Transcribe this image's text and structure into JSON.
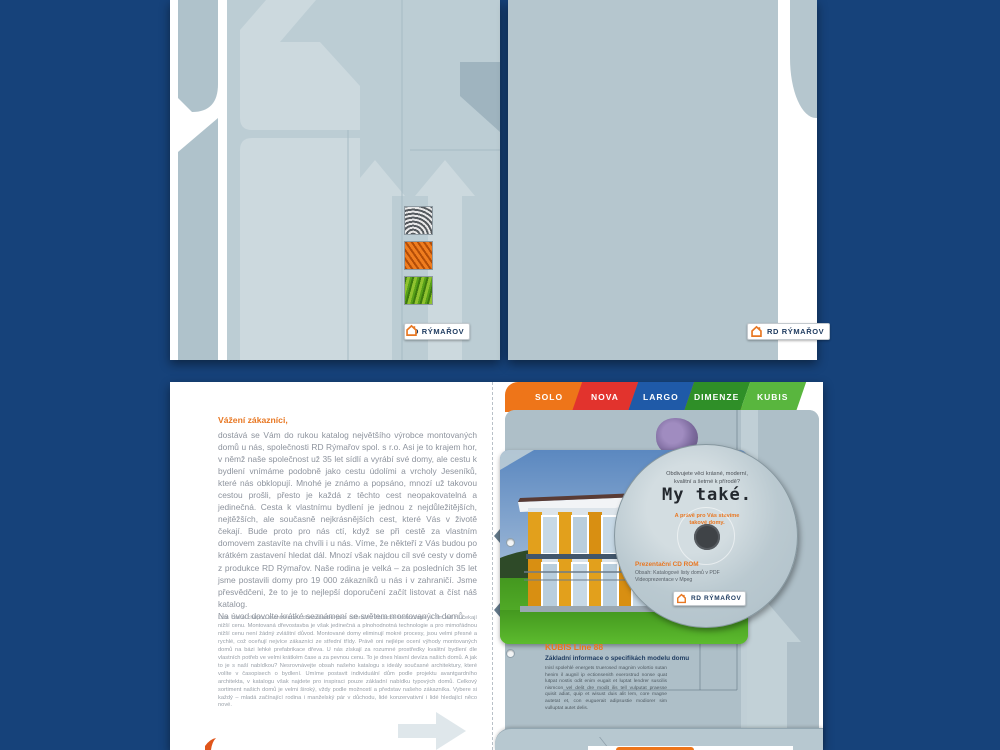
{
  "colors": {
    "background_navy": "#16427a",
    "cover_blue_gray": "#b5c6ce",
    "accent_orange": "#e87722",
    "tab_solo": "#ee7519",
    "tab_nova": "#e2332d",
    "tab_largo": "#1f5aa8",
    "tab_dimenze": "#2f8f28",
    "tab_kubis": "#59b63e"
  },
  "cover_front": {
    "logo": "RD RÝMAŘOV",
    "textures": [
      {
        "name": "fingerprint-texture"
      },
      {
        "name": "wood-texture"
      },
      {
        "name": "grass-texture"
      }
    ]
  },
  "cover_back": {
    "logo": "RD RÝMAŘOV"
  },
  "spread": {
    "left_page": {
      "heading": "Vážení zákazníci,",
      "paragraph1": "dostává se Vám do rukou katalog největšího výrobce montovaných domů u nás, společnosti RD Rýmařov spol. s r.o. Asi je to krajem hor, v němž naše společnost už 35 let sídlí a vyrábí své domy, ale cestu k bydlení vnímáme podobně jako cestu údolími a vrcholy Jeseníků, které nás obklopují. Mnohé je známo a popsáno, mnozí už takovou cestou prošli, přesto je každá z těchto cest neopakovatelná a jedinečná. Cesta k vlastnímu bydlení je jednou z nejdůležitějších, nejtěžších, ale současně nejkrásnějších cest, které Vás v životě čekají. Bude proto pro nás ctí, když se při cestě za vlastním domovem zastavíte na chvíli i u nás. Víme, že někteří z Vás budou po krátkém zastavení hledat dál. Mnozí však najdou cíl své cesty v domě z produkce RD Rýmařov. Naše rodina je velká – za posledních 35 let jsme postavili domy pro 19 000 zákazníků u nás i v zahraničí. Jsme přesvědčeni, že to je to nejlepší doporučení začít listovat a číst náš katalog.\nNa úvod dovolte krátké seznámení se světem montovaných domů.",
      "paragraph2": "Lidé často chápou montovanou dřevostavbu jako náhražku klasické technologie a tím od ní čekají nižší cenu. Montovaná dřevostavba je však jedinečná a plnohodnotná technologie a pro mimořádnou nižší cenu není žádný zvláštní důvod. Montované domy eliminují mokré procesy, jsou velmi přesné a rychlé, což oceňují nejvíce zákazníci ze střední třídy. Právě oni nejlépe ocení výhody montovaných domů na bázi lehké prefabrikace dřeva. U nás získají za rozumné prostředky kvalitní bydlení dle vlastních potřeb ve velmi krátkém čase a za pevnou cenu. To je dnes hlavní devíza našich domů. A jak to je s naší nabídkou? Nesrovnávejte obsah našeho katalogu s ideály současné architektury, které volíte v časopisech o bydlení. Umíme postavit individuální dům podle projektu avantgardního architekta, v katalogu však najdete pro inspiraci pouze základní nabídku typových domů. Celkový sortiment našich domů je velmi široký, vždy podle možností a představ našeho zákazníka. Vybere si každý – mladá začínající rodina i manželský pár v důchodu, lidé konzervativní i lidé hledající něco nové."
    },
    "tabs": [
      {
        "label": "SOLO",
        "color": "#ee7519"
      },
      {
        "label": "NOVA",
        "color": "#e2332d"
      },
      {
        "label": "LARGO",
        "color": "#1f5aa8"
      },
      {
        "label": "DIMENZE",
        "color": "#2f8f28"
      },
      {
        "label": "KUBIS",
        "color": "#59b63e"
      }
    ],
    "cd": {
      "question_line1": "Obdivujete věci krásné, moderní,",
      "question_line2": "kvalitní a šetrné k přírodě?",
      "title": "My také.",
      "orange_line1": "A právě pro Vás stavíme",
      "orange_line2": "takové domy.",
      "product": "Prezentační CD ROM",
      "contents_line1": "Obsah: Katalogové listy domů v PDF",
      "contents_line2": "Videoprezentace v Mpeg",
      "logo": "RD RÝMAŘOV"
    },
    "model": {
      "name": "KUBIS Line 88",
      "subtitle": "Základní informace o specifikách modelu domu",
      "body": "Inisl spolehlé energets truerosed magnim volortio sutan henim il augnil ip ectionsenith exerostrud nonse quat lutpat nostis odit enim eugait et luptat lendrer suscilis nismcon vel delit dre modit ilis tell vulputat praesse quisit adiat, quip et wisust duis alit lem, core magne autetat et, con euguerait adipsustie modiorer sim vulluptat autet delis."
    }
  }
}
